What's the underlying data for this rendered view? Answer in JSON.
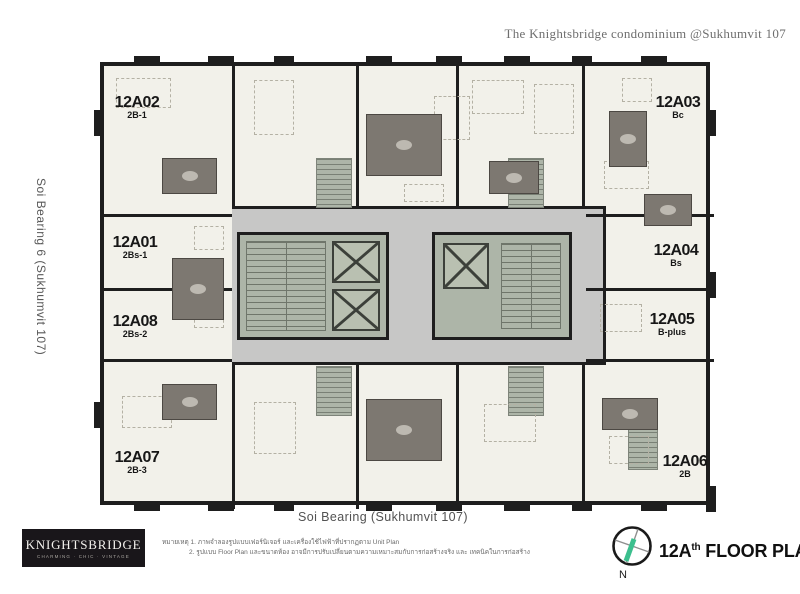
{
  "header": {
    "title": "The Knightsbridge condominium @Sukhumvit 107"
  },
  "roads": {
    "left": "Soi Bearing 6 (Sukhumvit 107)",
    "bottom": "Soi Bearing  (Sukhumvit 107)"
  },
  "units": [
    {
      "code": "12A02",
      "type": "2B-1"
    },
    {
      "code": "12A01",
      "type": "2Bs-1"
    },
    {
      "code": "12A08",
      "type": "2Bs-2"
    },
    {
      "code": "12A07",
      "type": "2B-3"
    },
    {
      "code": "12A03",
      "type": "Bc"
    },
    {
      "code": "12A04",
      "type": "Bs"
    },
    {
      "code": "12A05",
      "type": "B-plus"
    },
    {
      "code": "12A06",
      "type": "2B"
    }
  ],
  "logo": {
    "name": "KNIGHTSBRIDGE",
    "tagline": "CHARMING · CHIC · VINTAGE"
  },
  "notes": {
    "line1": "หมายเหตุ  1. ภาพจำลองรูปแบบเฟอร์นิเจอร์ และเครื่องใช้ไฟฟ้าที่ปรากฏตาม Unit Plan",
    "line2": "2. รูปแบบ Floor Plan และขนาดห้อง อาจมีการปรับเปลี่ยนตามความเหมาะสมกับการก่อสร้างจริง และ เทคนิคในการก่อสร้าง"
  },
  "plan_title": {
    "number": "12A",
    "ordinal": "th",
    "suffix": " FLOOR PLAN",
    "compass_n": "N"
  },
  "colors": {
    "wall": "#1e1e1e",
    "plan-bg": "#f2f1ea",
    "corridor": "#c7c7c6",
    "core-bg": "#adb5a8",
    "bath": "#7d7871",
    "accent-green": "#3cbf8e"
  }
}
